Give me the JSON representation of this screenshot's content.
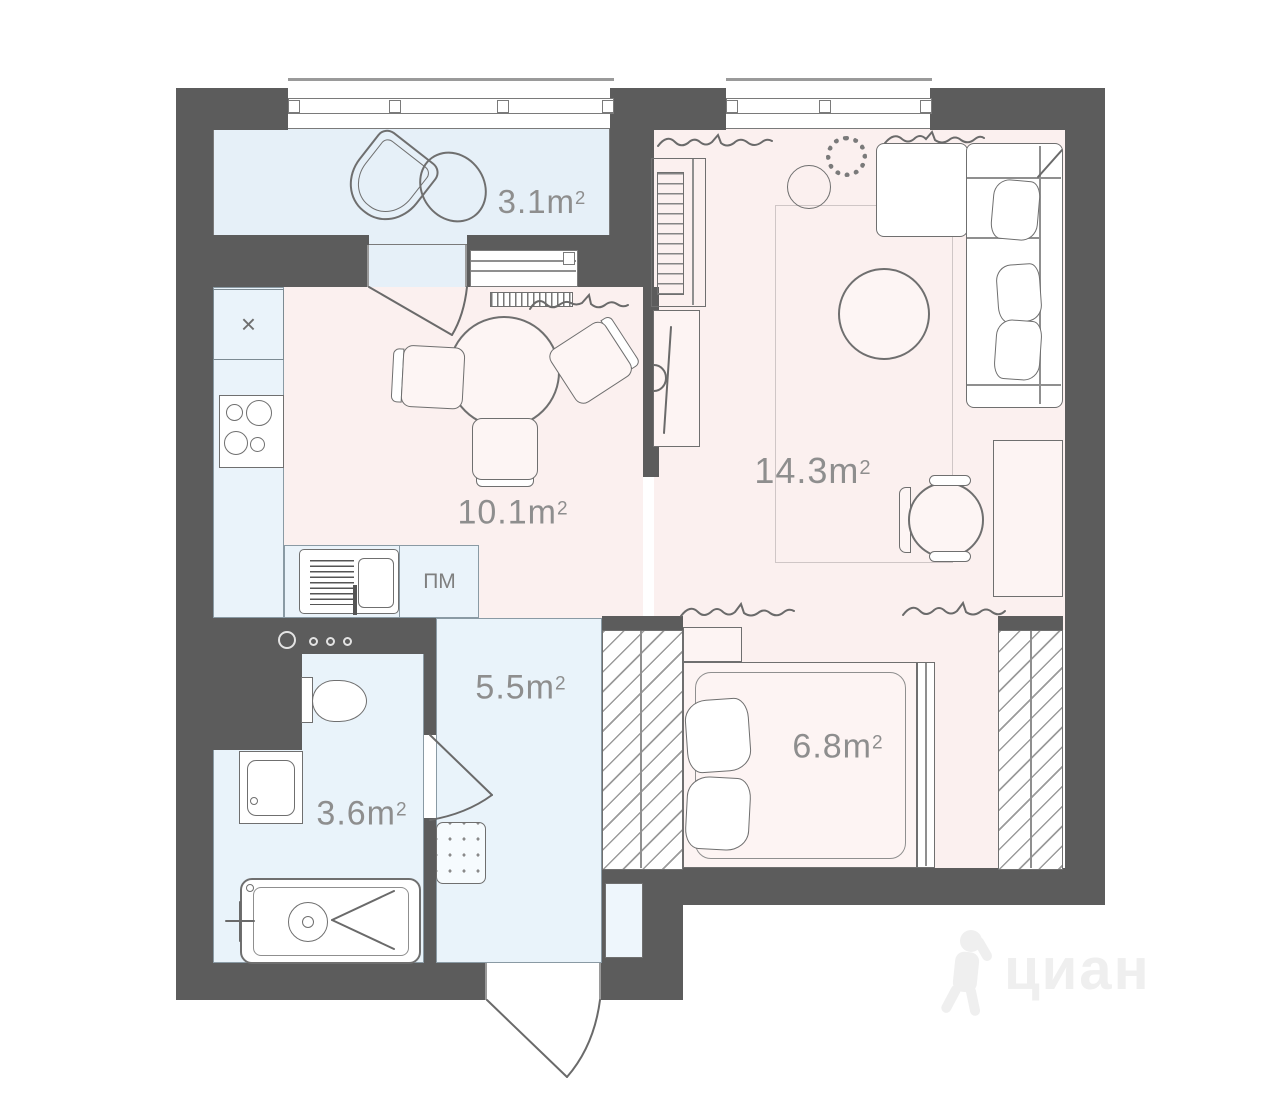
{
  "plan": {
    "watermark": "циан",
    "labels": {
      "dishwasher": "ПМ",
      "sink_symbol": "×"
    },
    "rooms": [
      {
        "id": "balcony",
        "area": "3.1m",
        "sup": "2"
      },
      {
        "id": "kitchen",
        "area": "10.1m",
        "sup": "2"
      },
      {
        "id": "living-room",
        "area": "14.3m",
        "sup": "2"
      },
      {
        "id": "hallway",
        "area": "5.5m",
        "sup": "2"
      },
      {
        "id": "bathroom",
        "area": "3.6m",
        "sup": "2"
      },
      {
        "id": "bedroom",
        "area": "6.8m",
        "sup": "2"
      }
    ],
    "colors": {
      "wall": "#5c5c5c",
      "floor_warm": "#fbf0ef",
      "floor_cool": "#e9f3fa",
      "outline": "#6f6f6f",
      "area_label": "#8e8e8e",
      "watermark": "#efefef"
    }
  }
}
